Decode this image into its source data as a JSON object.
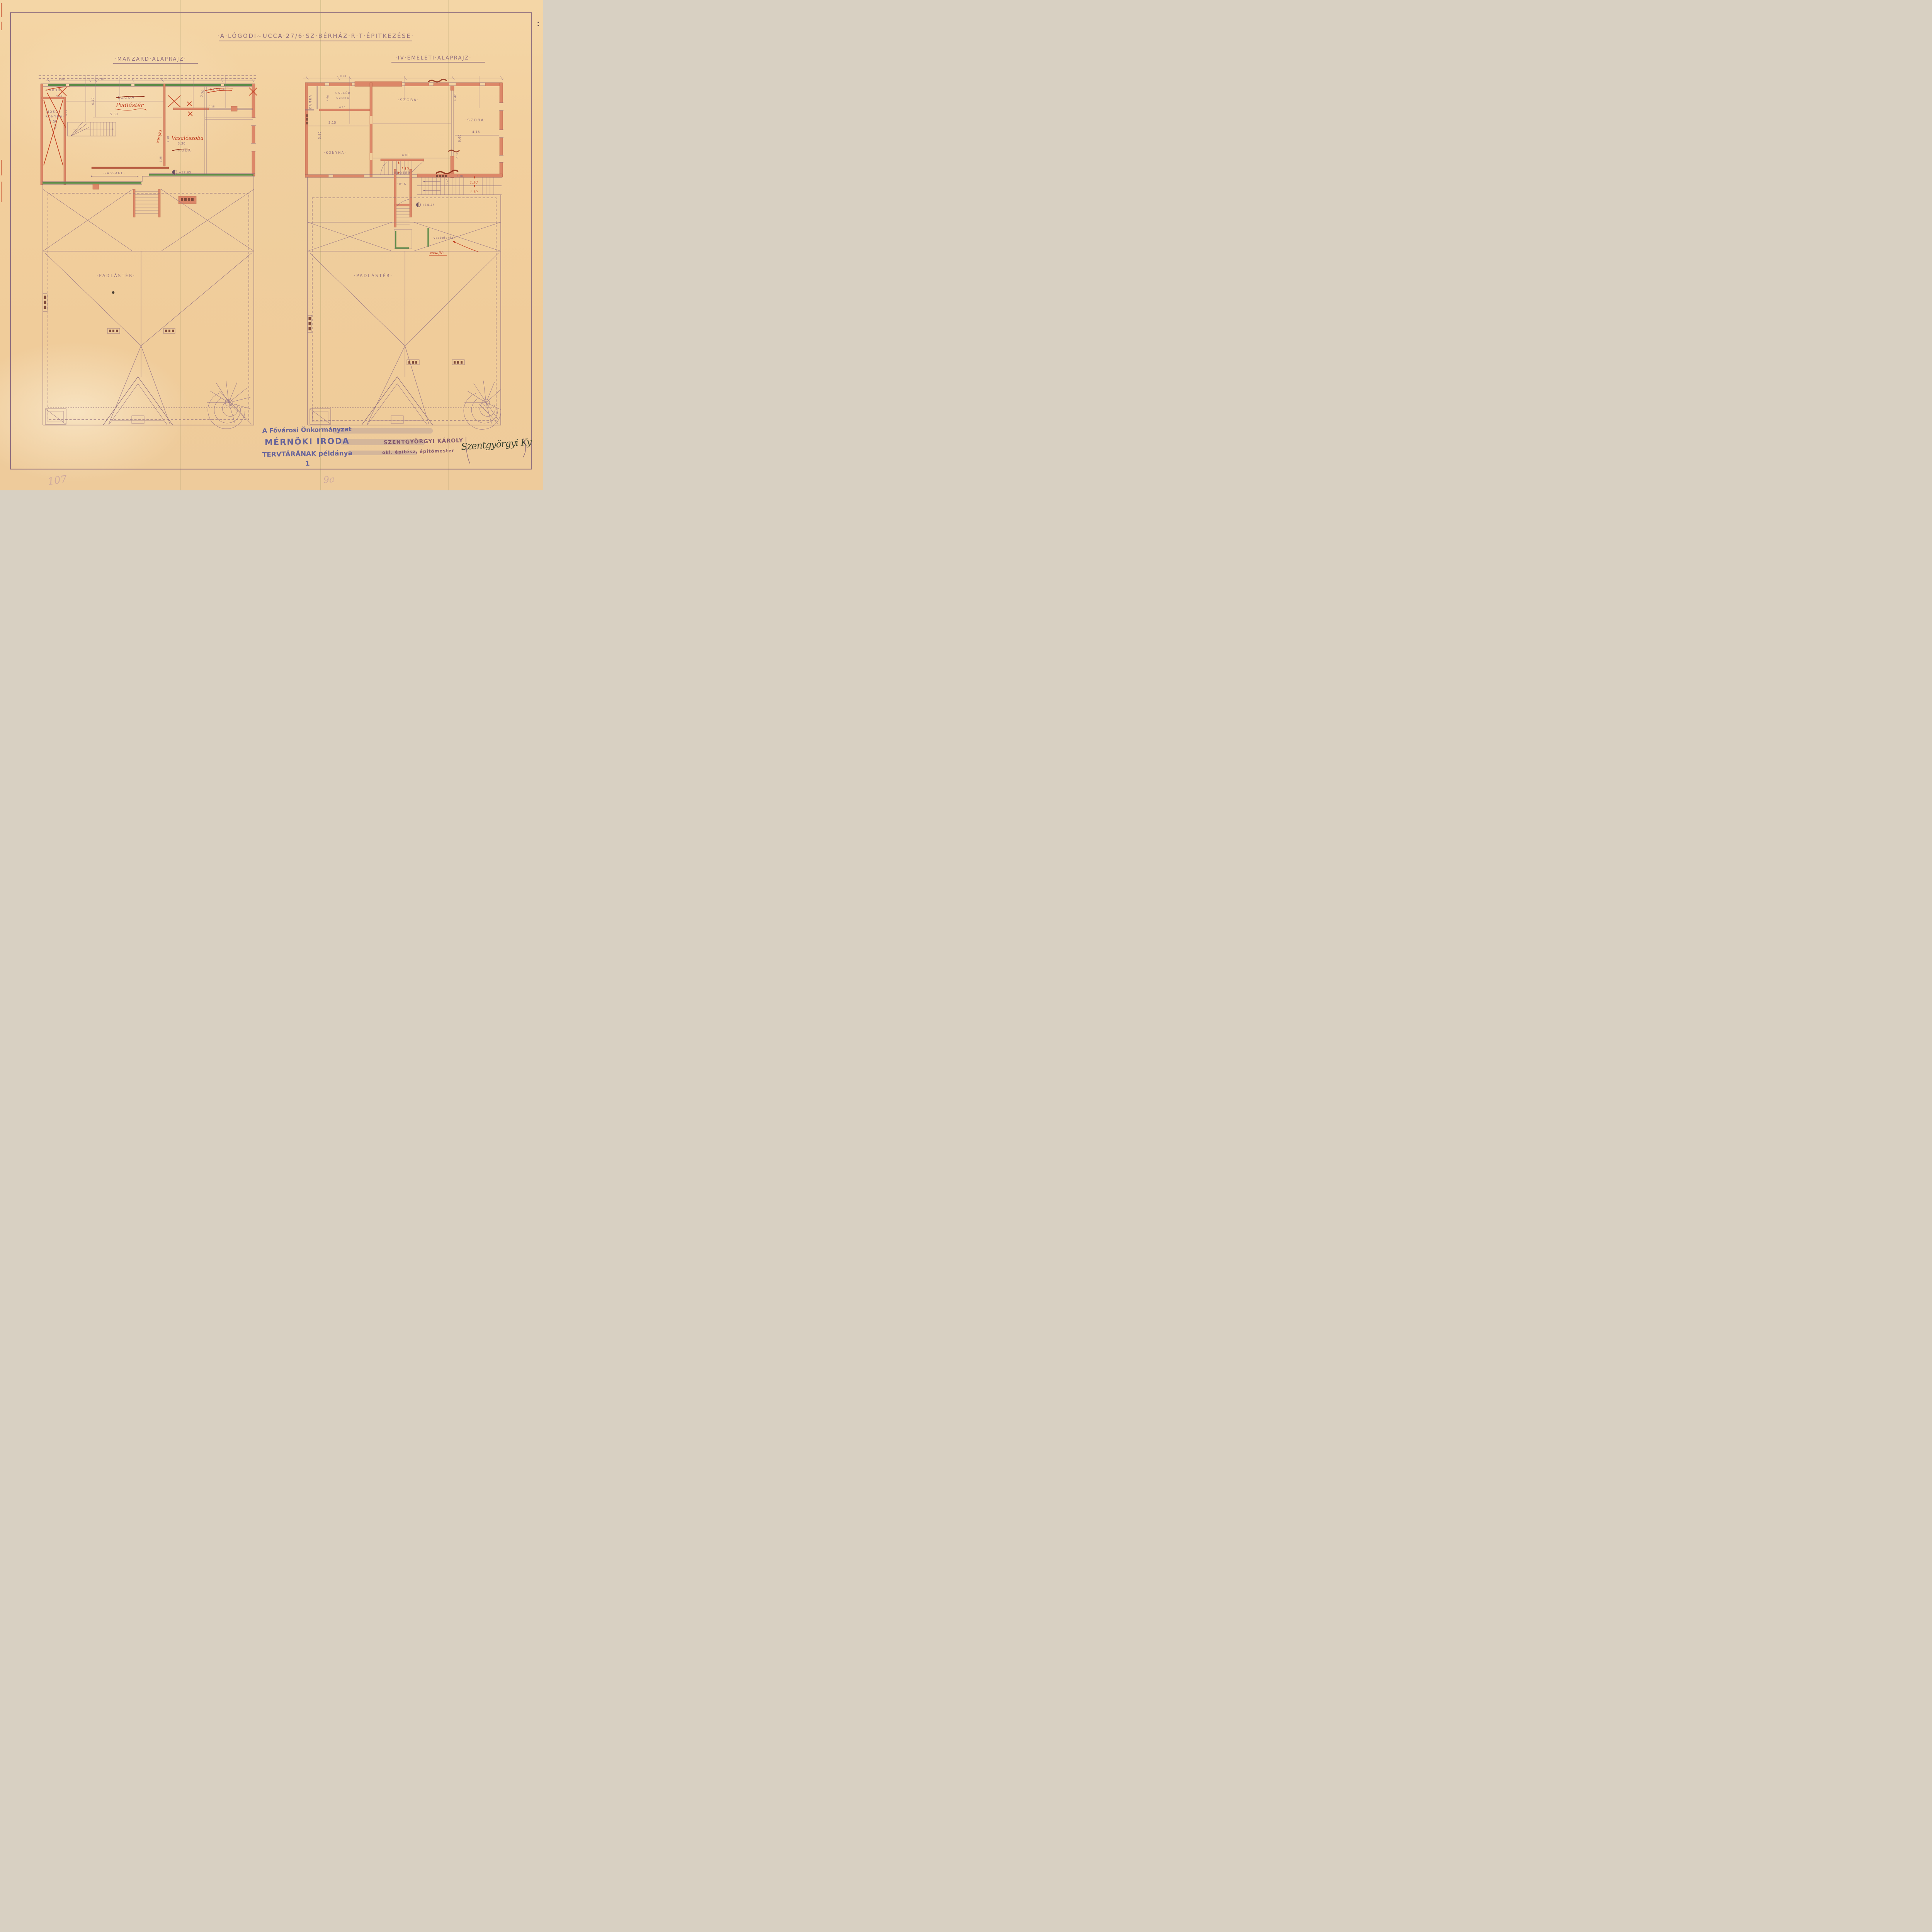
{
  "colors": {
    "paper": "#f2cf9d",
    "ink": "#8f6e7e",
    "wall_salmon": "#dc8768",
    "wall_dark": "#b8593f",
    "red_ink": "#c23f22",
    "dark_red": "#8e2c17",
    "green": "#5d8b49",
    "stamp_blue": "#4f519b",
    "stamp_purple": "#784d6a",
    "signature_ink": "#3a4431"
  },
  "header": {
    "title": "·A·LÓGODI~UCCA·27/6·SZ·BÉRHÁZ·R·T·ÉPITKEZÉSE·"
  },
  "left_plan": {
    "title": "·MANZARD·ALAPRAJZ·",
    "rooms": {
      "furdo": "FÜRDŐ",
      "moso_line1": "MOSÓ~",
      "moso_line2": "KONYHA·",
      "szoba_center": "SZOBA",
      "szoba_right": "·SZOBA·",
      "iroda": "·IRODA·",
      "passage": "·PASSAGE·"
    },
    "red_notes": {
      "padlaster": "Padlástér",
      "vasaloszoba": "Vasalószoba",
      "vasajto": "vasajtó"
    },
    "dims": {
      "w_025": "0.25",
      "w_045": "0.45",
      "w_013a": "0.13",
      "w_013b": "0.13",
      "room_350": "3.50",
      "room_450": "4.50",
      "room_530": "5.30",
      "room_440": "4.40",
      "room_250": "2.50",
      "w_015": "0.15",
      "room_330": "3.30",
      "w_010": "0.10",
      "w_225": "2.25",
      "level": "+17.65"
    },
    "roof_label": "·PADLÁSTÉR·"
  },
  "right_plan": {
    "title": "·IV·EMELETI·ALAPRAJZ·",
    "rooms": {
      "kamra": "KAMRA·",
      "cseled_line1": "CSELÉD",
      "cseled_line2": "·SZOBA·",
      "szoba_mid": "·SZOBA·",
      "szoba_right": "·SZOBA·",
      "konyha": "·KONYHA·",
      "eloter": "·ELŐTÉR·",
      "wc": "·W·C·"
    },
    "notes": {
      "vasbetonfal": "vasbetonfal",
      "vasajto": "vasajtó"
    },
    "dims": {
      "w_038a": "0.38",
      "room_240": "2.40",
      "w_010a": "0.10",
      "room_315": "3.15",
      "room_380": "3.80",
      "room_400": "4.00",
      "room_440": "4.40",
      "room_660": "6.60",
      "room_415": "4.15",
      "w_010b": "0.10",
      "hall_240": "2.40",
      "stair_110a": "1.10",
      "stair_110b": "1.10",
      "stair_110c": "1.10",
      "w_038b": "0.38",
      "level": "+14.45"
    },
    "roof_label": "·PADLÁSTÉR·"
  },
  "stamps": {
    "archive_line1": "A Fővárosi Önkormányzat",
    "archive_line2": "MÉRNÖKI IRODA",
    "archive_line3": "TERVTÁRÁNAK példánya",
    "page_number": "1",
    "architect_line1": "SZENTGYÖRGYI KÁROLY",
    "architect_line2": "okl. építész, építőmester",
    "signature": "Szentgyörgyi Ky",
    "pencil_left": "107",
    "pencil_right": "9a"
  }
}
